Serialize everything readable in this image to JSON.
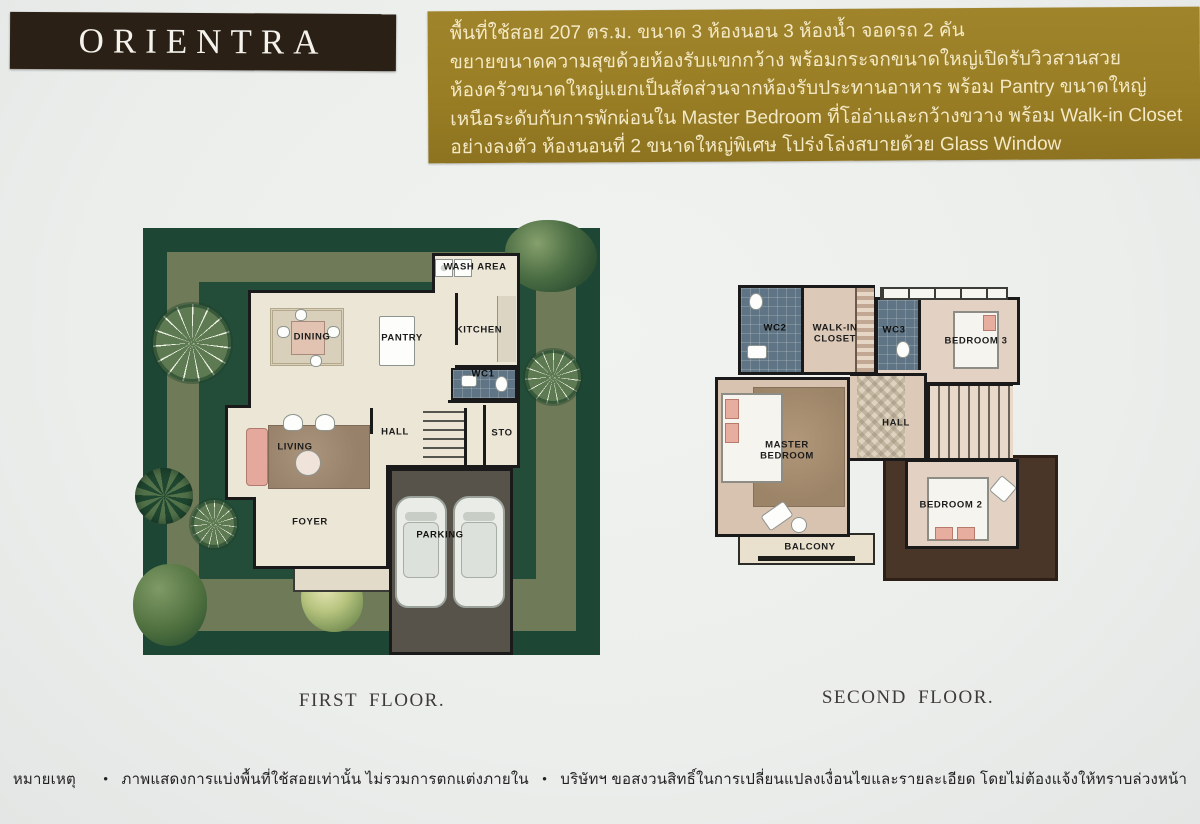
{
  "header": {
    "brand": "ORIENTRA",
    "gold_box_lines": [
      "พื้นที่ใช้สอย 207 ตร.ม. ขนาด 3 ห้องนอน 3 ห้องน้ำ จอดรถ 2 คัน",
      "ขยายขนาดความสุขด้วยห้องรับแขกกว้าง พร้อมกระจกขนาดใหญ่เปิดรับวิวสวนสวย",
      "ห้องครัวขนาดใหญ่แยกเป็นสัดส่วนจากห้องรับประทานอาหาร พร้อม Pantry ขนาดใหญ่",
      "เหนือระดับกับการพักผ่อนใน Master Bedroom ที่โอ่อ่าและกว้างขวาง พร้อม Walk-in Closet",
      "อย่างลงตัว ห้องนอนที่ 2 ขนาดใหญ่พิเศษ โปร่งโล่งสบายด้วย Glass Window"
    ]
  },
  "first_floor": {
    "caption": "FIRST FLOOR.",
    "rooms": {
      "wash_area": "WASH AREA",
      "kitchen": "KITCHEN",
      "pantry": "PANTRY",
      "dining": "DINING",
      "wc1": "WC1",
      "hall": "HALL",
      "storage": "STO",
      "living": "LIVING",
      "foyer": "FOYER",
      "parking": "PARKING"
    }
  },
  "second_floor": {
    "caption": "SECOND FLOOR.",
    "rooms": {
      "wc2": "WC2",
      "walk_in_closet": "WALK-IN CLOSET",
      "wc3": "WC3",
      "bedroom3": "BEDROOM 3",
      "master_bedroom": "MASTER BEDROOM",
      "hall": "HALL",
      "bedroom2": "BEDROOM 2",
      "balcony": "BALCONY"
    }
  },
  "footer": {
    "note_label": "หมายเหตุ",
    "bullet": "•",
    "disclaimer_usage": "ภาพแสดงการแบ่งพื้นที่ใช้สอยเท่านั้น ไม่รวมการตกแต่งภายใน",
    "disclaimer_rights": "บริษัทฯ ขอสงวนสิทธิ์ในการเปลี่ยนแปลงเงื่อนไขและรายละเอียด โดยไม่ต้องแจ้งให้ทราบล่วงหน้า"
  },
  "colors": {
    "gold_box": "#9a7e25",
    "brand_bar": "#2b2015",
    "garden_hedge": "#1e4634",
    "garden_path": "#6e7a58",
    "floor_cream": "#ece6d7",
    "wall_black": "#1a1a1a",
    "wc_tile": "#5f7484",
    "parking_asphalt": "#57534b",
    "wood_floor": "#dcc9b8",
    "roof_brown": "#4a3529"
  }
}
